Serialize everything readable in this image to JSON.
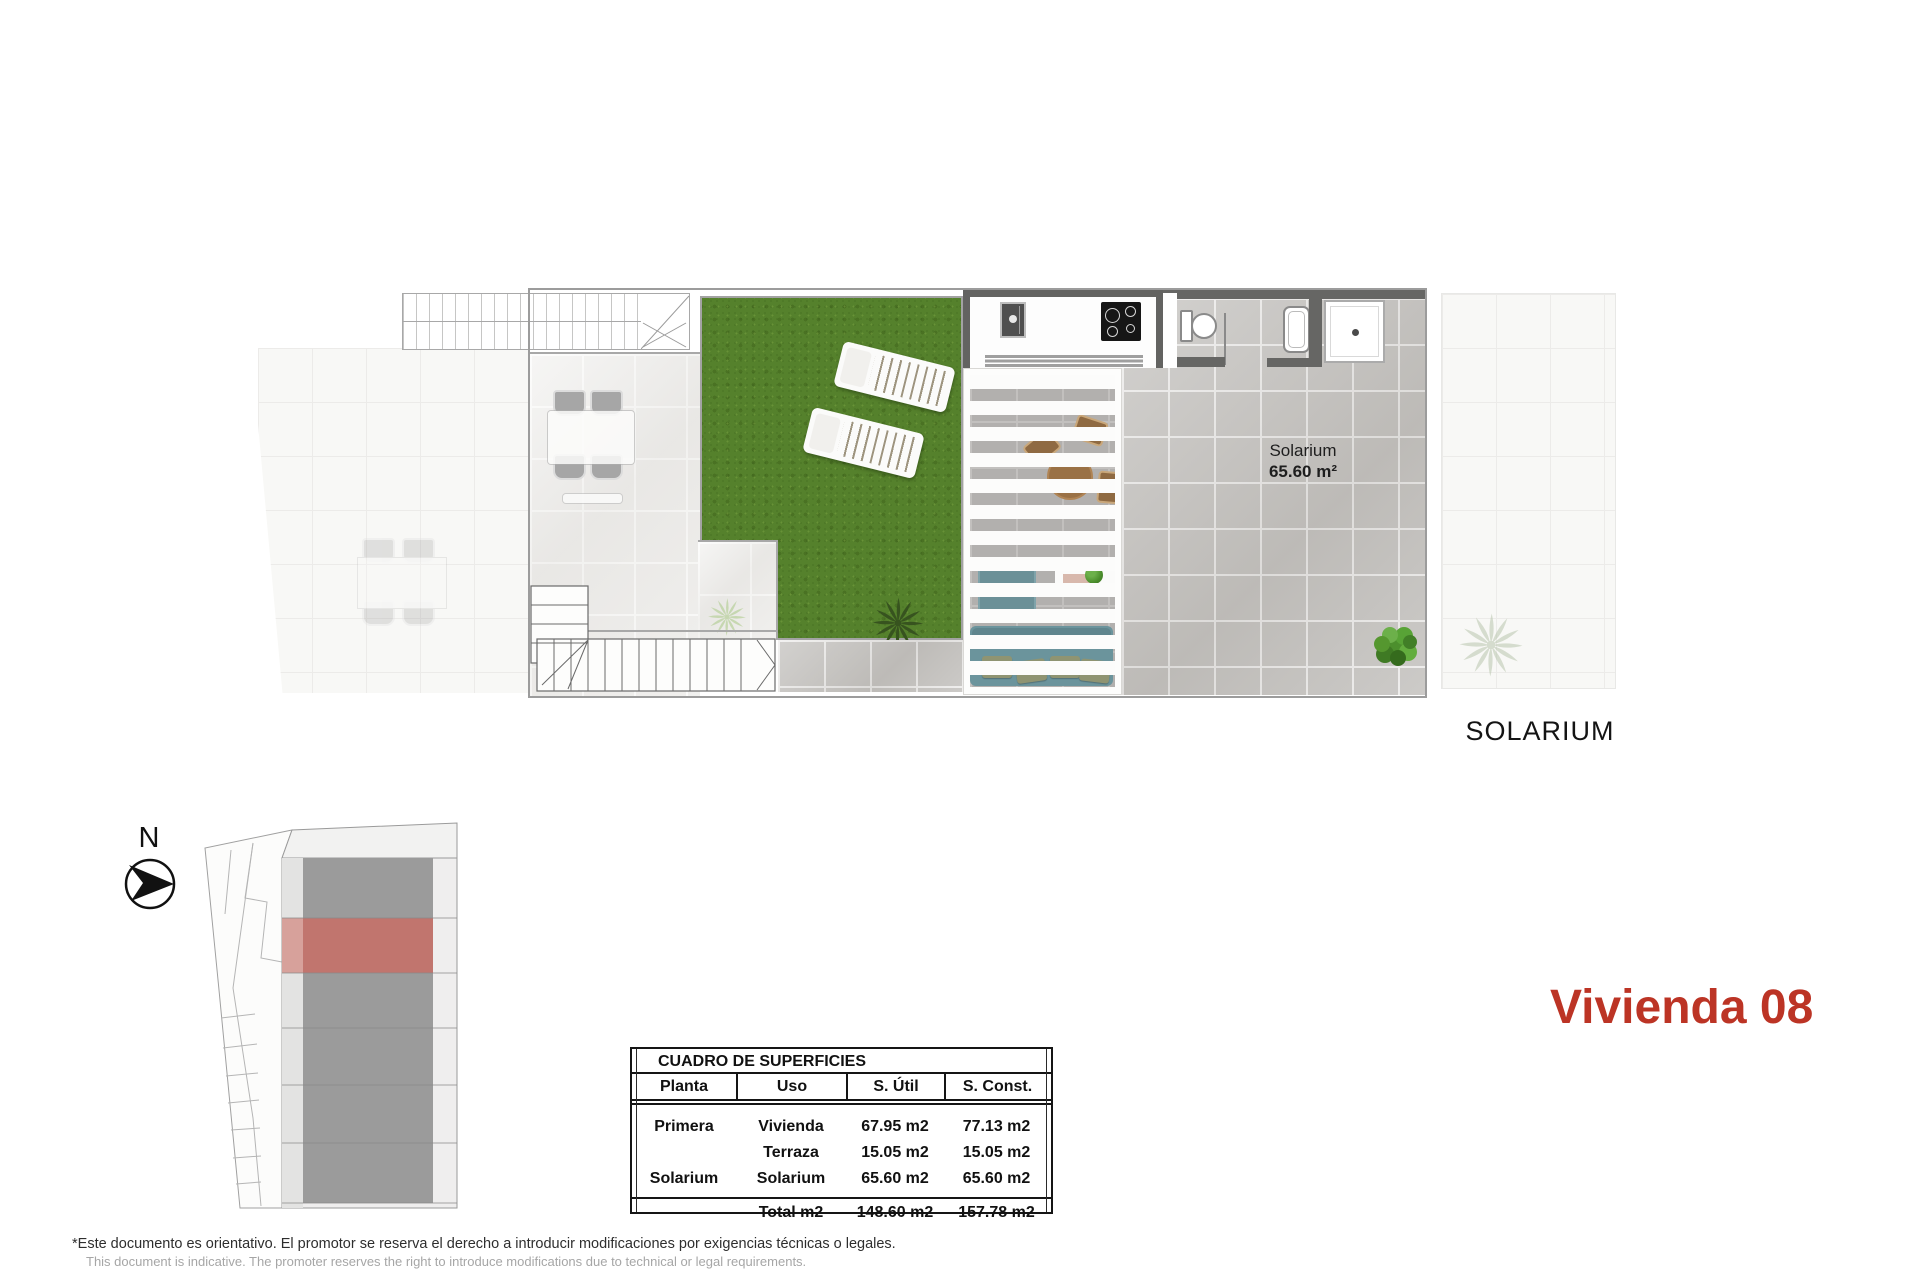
{
  "document": {
    "sheet_title": "Vivienda 08",
    "floor_name": "SOLARIUM"
  },
  "plan": {
    "room_label": {
      "name": "Solarium",
      "area": "65.60 m²"
    }
  },
  "compass": {
    "north": "N"
  },
  "surface_table": {
    "title": "CUADRO DE SUPERFICIES",
    "columns": [
      "Planta",
      "Uso",
      "S. Útil",
      "S. Const."
    ],
    "rows": [
      {
        "planta": "Primera",
        "uso": "Vivienda",
        "util": "67.95 m2",
        "const": "77.13 m2"
      },
      {
        "planta": "",
        "uso": "Terraza",
        "util": "15.05 m2",
        "const": "15.05 m2"
      },
      {
        "planta": "Solarium",
        "uso": "Solarium",
        "util": "65.60 m2",
        "const": "65.60 m2"
      }
    ],
    "total": {
      "label": "Total m2",
      "util": "148.60 m2",
      "const": "157.78 m2"
    }
  },
  "footer": {
    "disclaimer_es": "*Este documento es orientativo. El promotor se reserva el derecho a introducir modificaciones por exigencias técnicas o legales.",
    "disclaimer_en": "This document is indicative. The promoter reserves the right to introduce modifications due to technical or legal requirements."
  },
  "colors": {
    "accent_red": "#bc3425",
    "highlight_unit_red": "#c1756e",
    "grass_green": "#55812c",
    "wall_gray": "#666664"
  }
}
